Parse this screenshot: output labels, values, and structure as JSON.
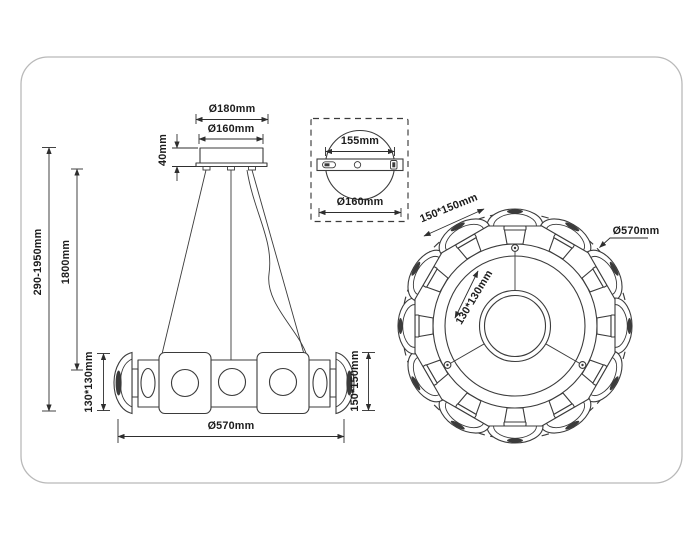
{
  "colors": {
    "line": "#3b3b3b",
    "text": "#1c1c1c",
    "card_border": "#b9b9b9",
    "background": "#ffffff"
  },
  "side_view": {
    "dim_plate_diameter": "Ø180mm",
    "dim_canopy_diameter": "Ø160mm",
    "dim_canopy_height": "40mm",
    "dim_wire_length": "1800mm",
    "dim_total_height": "290-1950mm",
    "dim_shade_left": "130*130mm",
    "dim_shade_right": "150*150mm",
    "dim_fixture_diameter": "Ø570mm"
  },
  "detail_view": {
    "dim_bracket_length": "155mm",
    "dim_plate_diameter": "Ø160mm"
  },
  "top_view": {
    "dim_shade_size": "150*150mm",
    "dim_fixture_diameter": "Ø570mm",
    "dim_inner_shade_size": "130*130mm"
  }
}
